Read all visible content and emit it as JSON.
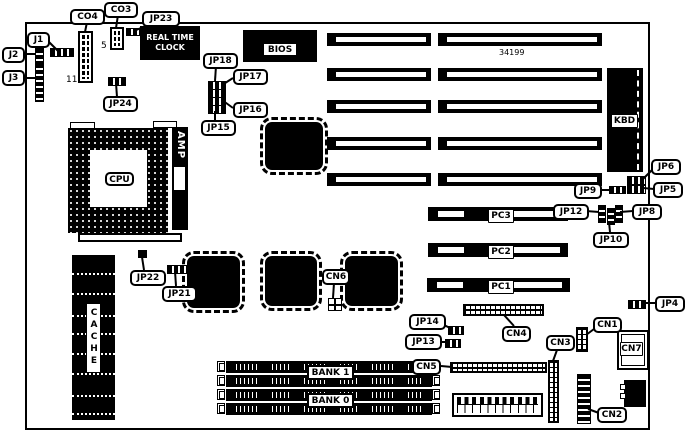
{
  "board": {
    "type": "motherboard-layout-diagram",
    "part_number": "34199",
    "chips": {
      "cpu": "CPU",
      "bios": "BIOS",
      "kbd": "KBD",
      "amp": "AMP",
      "cache": "CACHE",
      "rtc_line1": "REAL TIME",
      "rtc_line2": "CLOCK"
    },
    "pin_numbers": {
      "co4": "11",
      "co3": "5"
    },
    "slots": {
      "pc1": "PC1",
      "pc2": "PC2",
      "pc3": "PC3",
      "bank0": "BANK 0",
      "bank1": "BANK 1"
    },
    "labels": {
      "co4": "CO4",
      "co3": "CO3",
      "jp23": "JP23",
      "j1": "J1",
      "j2": "J2",
      "j3": "J3",
      "jp24": "JP24",
      "jp18": "JP18",
      "jp17": "JP17",
      "jp16": "JP16",
      "jp15": "JP15",
      "jp22": "JP22",
      "jp21": "JP21",
      "cn6": "CN6",
      "jp14": "JP14",
      "jp13": "JP13",
      "cn5": "CN5",
      "cn4": "CN4",
      "cn3": "CN3",
      "cn1": "CN1",
      "cn7": "CN7",
      "cn2": "CN2",
      "jp12": "JP12",
      "jp10": "JP10",
      "jp8": "JP8",
      "jp9": "JP9",
      "jp6": "JP6",
      "jp5": "JP5",
      "jp4": "JP4"
    }
  }
}
